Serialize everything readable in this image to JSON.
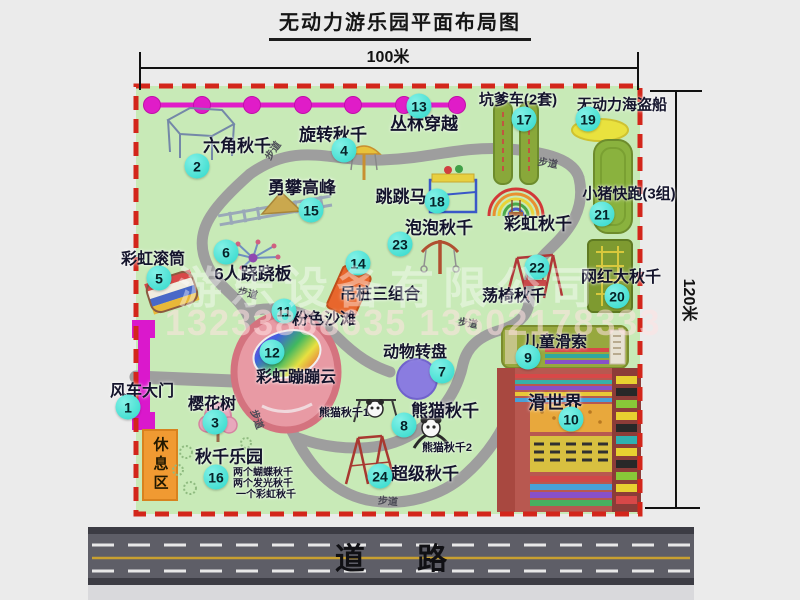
{
  "title": "无动力游乐园平面布局图",
  "dimensions": {
    "width_label": "100米",
    "height_label": "120米"
  },
  "road": {
    "label": "道 路"
  },
  "watermark": {
    "company": "游乐设备有限公司",
    "phones": "13233868635 13602178333"
  },
  "colors": {
    "park_green": "#c8eab7",
    "border_red": "#d3261b",
    "path_gray": "#9e9e9e",
    "marker_cyan": "#2ed8ca",
    "chain_magenta": "#e01cc8",
    "gate_magenta": "#da18cc",
    "rest_orange": "#f09a32",
    "road_gray": "#5e5e67",
    "road_center_yellow": "#c8a030"
  },
  "map": {
    "markers": [
      {
        "num": "1",
        "x": 128,
        "y": 407
      },
      {
        "num": "2",
        "x": 197,
        "y": 166
      },
      {
        "num": "3",
        "x": 215,
        "y": 422
      },
      {
        "num": "4",
        "x": 344,
        "y": 150
      },
      {
        "num": "5",
        "x": 159,
        "y": 278
      },
      {
        "num": "6",
        "x": 226,
        "y": 252
      },
      {
        "num": "7",
        "x": 442,
        "y": 371
      },
      {
        "num": "8",
        "x": 404,
        "y": 425
      },
      {
        "num": "9",
        "x": 528,
        "y": 357
      },
      {
        "num": "10",
        "x": 571,
        "y": 419
      },
      {
        "num": "11",
        "x": 284,
        "y": 311
      },
      {
        "num": "12",
        "x": 272,
        "y": 352
      },
      {
        "num": "13",
        "x": 419,
        "y": 106
      },
      {
        "num": "14",
        "x": 358,
        "y": 263
      },
      {
        "num": "15",
        "x": 311,
        "y": 210
      },
      {
        "num": "16",
        "x": 216,
        "y": 477
      },
      {
        "num": "17",
        "x": 524,
        "y": 119
      },
      {
        "num": "18",
        "x": 437,
        "y": 201
      },
      {
        "num": "19",
        "x": 588,
        "y": 119
      },
      {
        "num": "20",
        "x": 617,
        "y": 296
      },
      {
        "num": "21",
        "x": 602,
        "y": 214
      },
      {
        "num": "22",
        "x": 537,
        "y": 267
      },
      {
        "num": "23",
        "x": 400,
        "y": 244
      },
      {
        "num": "24",
        "x": 380,
        "y": 476
      }
    ],
    "labels": [
      {
        "name": "hexagon-swing-label",
        "text": "六角秋千",
        "x": 237,
        "y": 144,
        "size": 17
      },
      {
        "name": "rotating-swing-label",
        "text": "旋转秋千",
        "x": 333,
        "y": 133,
        "size": 17
      },
      {
        "name": "jungle-crossing-label",
        "text": "丛林穿越",
        "x": 424,
        "y": 122,
        "size": 17
      },
      {
        "name": "pit-car-label",
        "text": "坑爹车(2套)",
        "x": 518,
        "y": 99,
        "size": 15
      },
      {
        "name": "pirate-ship-label",
        "text": "无动力海盗船",
        "x": 622,
        "y": 104,
        "size": 15
      },
      {
        "name": "climbing-peak-label",
        "text": "勇攀高峰",
        "x": 302,
        "y": 186,
        "size": 17
      },
      {
        "name": "rainbow-roller-label",
        "text": "彩虹滚筒",
        "x": 153,
        "y": 257,
        "size": 16
      },
      {
        "name": "six-seesaw-label",
        "text": "6人跷跷板",
        "x": 253,
        "y": 272,
        "size": 17
      },
      {
        "name": "jumping-horse-label",
        "text": "跳跳马",
        "x": 401,
        "y": 195,
        "size": 17
      },
      {
        "name": "bubble-swing-label",
        "text": "泡泡秋千",
        "x": 439,
        "y": 226,
        "size": 17
      },
      {
        "name": "rainbow-swing-label",
        "text": "彩虹秋千",
        "x": 538,
        "y": 222,
        "size": 17
      },
      {
        "name": "piggy-run-label",
        "text": "小猪快跑(3组)",
        "x": 629,
        "y": 193,
        "size": 15
      },
      {
        "name": "viral-big-swing-label",
        "text": "网红大秋千",
        "x": 621,
        "y": 275,
        "size": 16
      },
      {
        "name": "hanging-pile-label",
        "text": "吊桩三组合",
        "x": 380,
        "y": 292,
        "size": 16
      },
      {
        "name": "chair-swing-label",
        "text": "荡椅秋千",
        "x": 514,
        "y": 294,
        "size": 16
      },
      {
        "name": "pink-beach-label",
        "text": "粉色沙滩",
        "x": 324,
        "y": 317,
        "size": 16
      },
      {
        "name": "rainbow-cloud-label",
        "text": "彩虹蹦蹦云",
        "x": 296,
        "y": 375,
        "size": 16
      },
      {
        "name": "animal-turntable-label",
        "text": "动物转盘",
        "x": 415,
        "y": 350,
        "size": 16
      },
      {
        "name": "zipline-label",
        "text": "儿童滑索",
        "x": 555,
        "y": 340,
        "size": 16
      },
      {
        "name": "slide-world-label",
        "text": "滑世界",
        "x": 555,
        "y": 402,
        "size": 18
      },
      {
        "name": "panda-swing-label",
        "text": "熊猫秋千",
        "x": 445,
        "y": 409,
        "size": 17
      },
      {
        "name": "panda-swing-1-label",
        "text": "熊猫秋千1",
        "x": 344,
        "y": 412,
        "size": 11
      },
      {
        "name": "panda-swing-2-label",
        "text": "熊猫秋千2",
        "x": 447,
        "y": 447,
        "size": 11
      },
      {
        "name": "super-swing-label",
        "text": "超级秋千",
        "x": 425,
        "y": 472,
        "size": 17
      },
      {
        "name": "swing-park-label",
        "text": "秋千乐园",
        "x": 229,
        "y": 455,
        "size": 17
      },
      {
        "name": "swing-park-item-1",
        "text": "两个蝴蝶秋千",
        "x": 233,
        "y": 471,
        "size": 10,
        "align": "left"
      },
      {
        "name": "swing-park-item-2",
        "text": "两个发光秋千",
        "x": 233,
        "y": 482,
        "size": 10,
        "align": "left"
      },
      {
        "name": "swing-park-item-3",
        "text": "一个彩虹秋千",
        "x": 236,
        "y": 493,
        "size": 10,
        "align": "left"
      },
      {
        "name": "cherry-tree-label",
        "text": "樱花树",
        "x": 212,
        "y": 402,
        "size": 16
      },
      {
        "name": "windmill-gate-label",
        "text": "风车大门",
        "x": 142,
        "y": 389,
        "size": 16
      },
      {
        "name": "rest-area-label",
        "text": "休息区",
        "x": 160,
        "y": 465,
        "size": 15,
        "cls": "vertical"
      },
      {
        "name": "path-label-1",
        "text": "步道",
        "x": 272,
        "y": 150,
        "size": 10,
        "cls": "path",
        "rotate": -55
      },
      {
        "name": "path-label-2",
        "text": "步道",
        "x": 548,
        "y": 162,
        "size": 10,
        "cls": "path",
        "rotate": 10
      },
      {
        "name": "path-label-3",
        "text": "步道",
        "x": 248,
        "y": 292,
        "size": 10,
        "cls": "path",
        "rotate": 15
      },
      {
        "name": "path-label-4",
        "text": "步道",
        "x": 468,
        "y": 322,
        "size": 10,
        "cls": "path",
        "rotate": 10
      },
      {
        "name": "path-label-5",
        "text": "步道",
        "x": 258,
        "y": 419,
        "size": 10,
        "cls": "path",
        "rotate": 70
      },
      {
        "name": "path-label-6",
        "text": "步道",
        "x": 388,
        "y": 500,
        "size": 10,
        "cls": "path",
        "rotate": 5
      }
    ]
  }
}
